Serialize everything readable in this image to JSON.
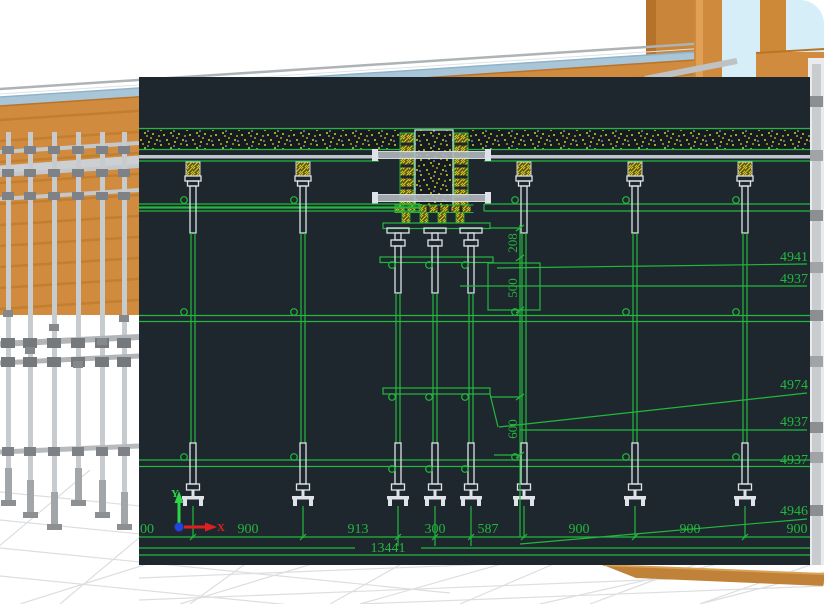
{
  "colors": {
    "cad-bg": "#1f272e",
    "cad-green": "#21b83c",
    "cad-white": "#dde3e8",
    "cad-yellow": "#d8cf25",
    "wood-orange": "#d08b3e",
    "slab-blue": "#a9c6d8",
    "sky-blue": "#d6eef7",
    "scaffold-gray": "#c6c9cb",
    "floor-line": "#dcdedf"
  },
  "cad": {
    "bottom_dims": [
      "00",
      "900",
      "913",
      "300",
      "587",
      "900",
      "900",
      "900"
    ],
    "total_dim": "13441",
    "vertical_dims": [
      "208",
      "500",
      "600"
    ],
    "elevation_labels": [
      "4941",
      "4937",
      "4974",
      "4937",
      "4937",
      "4946"
    ],
    "axis_labels": {
      "x": "X",
      "y": "Y"
    }
  }
}
